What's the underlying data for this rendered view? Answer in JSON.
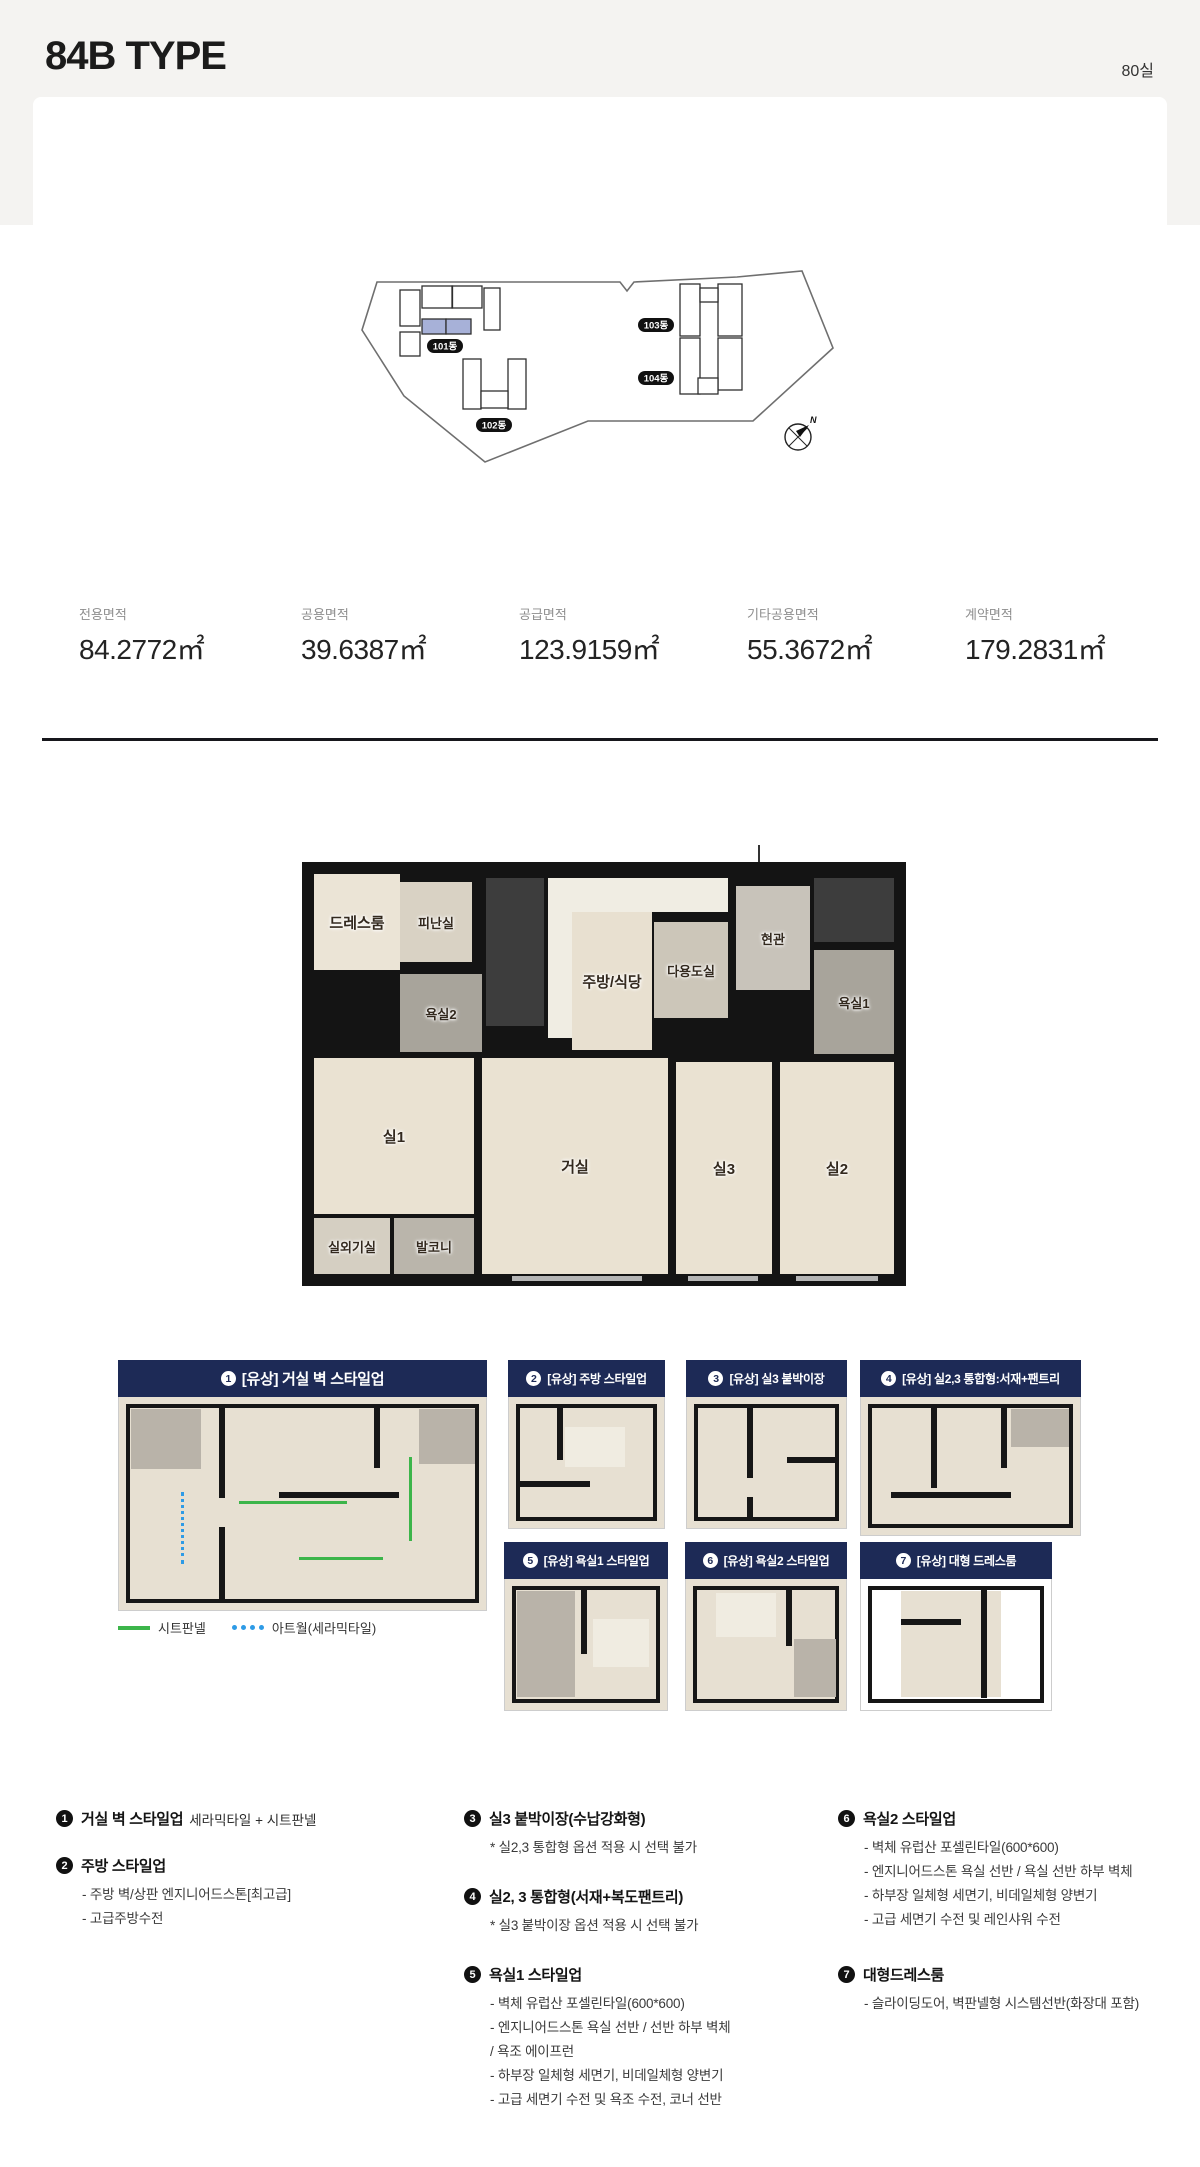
{
  "header": {
    "title": "84B TYPE",
    "unit_count": "80실"
  },
  "site_plan": {
    "buildings": [
      {
        "label": "101동",
        "highlighted": true
      },
      {
        "label": "102동",
        "highlighted": false
      },
      {
        "label": "103동",
        "highlighted": false
      },
      {
        "label": "104동",
        "highlighted": false
      }
    ],
    "compass": "N",
    "highlight_color": "#a7b1d8"
  },
  "areas": [
    {
      "label": "전용면적",
      "value": "84.2772㎡"
    },
    {
      "label": "공용면적",
      "value": "39.6387㎡"
    },
    {
      "label": "공급면적",
      "value": "123.9159㎡"
    },
    {
      "label": "기타공용면적",
      "value": "55.3672㎡"
    },
    {
      "label": "계약면적",
      "value": "179.2831㎡"
    }
  ],
  "floor_plan": {
    "rooms": [
      "드레스룸",
      "피난실",
      "욕실2",
      "주방/식당",
      "다용도실",
      "현관",
      "욕실1",
      "실1",
      "거실",
      "실3",
      "실2",
      "실외기실",
      "발코니"
    ]
  },
  "options": [
    {
      "no": "1",
      "title": "[유상] 거실 벽 스타일업"
    },
    {
      "no": "2",
      "title": "[유상] 주방 스타일업"
    },
    {
      "no": "3",
      "title": "[유상] 실3 붙박이장"
    },
    {
      "no": "4",
      "title": "[유상] 실2,3 통합형:서재+팬트리"
    },
    {
      "no": "5",
      "title": "[유상] 욕실1 스타일업"
    },
    {
      "no": "6",
      "title": "[유상] 욕실2 스타일업"
    },
    {
      "no": "7",
      "title": "[유상] 대형 드레스룸"
    }
  ],
  "legend": [
    {
      "label": "시트판넬",
      "color": "#3cb54a"
    },
    {
      "label": "아트월(세라믹타일)",
      "color": "#2e9be6"
    }
  ],
  "notes": {
    "col1": [
      {
        "no": "1",
        "title": "거실 벽 스타일업",
        "suffix": "세라믹타일 + 시트판넬",
        "subs": []
      },
      {
        "no": "2",
        "title": "주방 스타일업",
        "suffix": "",
        "subs": [
          "- 주방 벽/상판 엔지니어드스톤[최고급]",
          "- 고급주방수전"
        ]
      }
    ],
    "col2": [
      {
        "no": "3",
        "title": "실3 붙박이장(수납강화형)",
        "suffix": "",
        "subs": [
          "* 실2,3 통합형 옵션 적용 시 선택 불가"
        ]
      },
      {
        "no": "4",
        "title": "실2, 3 통합형(서재+복도팬트리)",
        "suffix": "",
        "subs": [
          "* 실3 붙박이장 옵션 적용 시 선택 불가"
        ]
      },
      {
        "no": "5",
        "title": "욕실1 스타일업",
        "suffix": "",
        "subs": [
          "- 벽체 유럽산 포셀린타일(600*600)",
          "- 엔지니어드스톤 욕실 선반 / 선반 하부 벽체",
          "/ 욕조 에이프런",
          "- 하부장 일체형 세면기, 비데일체형 양변기",
          "- 고급 세면기 수전 및 욕조 수전, 코너 선반"
        ]
      }
    ],
    "col3": [
      {
        "no": "6",
        "title": "욕실2 스타일업",
        "suffix": "",
        "subs": [
          "- 벽체 유럽산 포셀린타일(600*600)",
          "- 엔지니어드스톤 욕실 선반 / 욕실 선반 하부 벽체",
          "- 하부장 일체형 세면기, 비데일체형 양변기",
          "- 고급 세면기 수전 및 레인샤워 수전"
        ]
      },
      {
        "no": "7",
        "title": "대형드레스룸",
        "suffix": "",
        "subs": [
          "- 슬라이딩도어, 벽판넬형 시스템선반(화장대 포함)"
        ]
      }
    ]
  },
  "colors": {
    "accent_navy": "#1d2a56",
    "divider": "#17171c",
    "site_highlight": "#a7b1d8"
  }
}
